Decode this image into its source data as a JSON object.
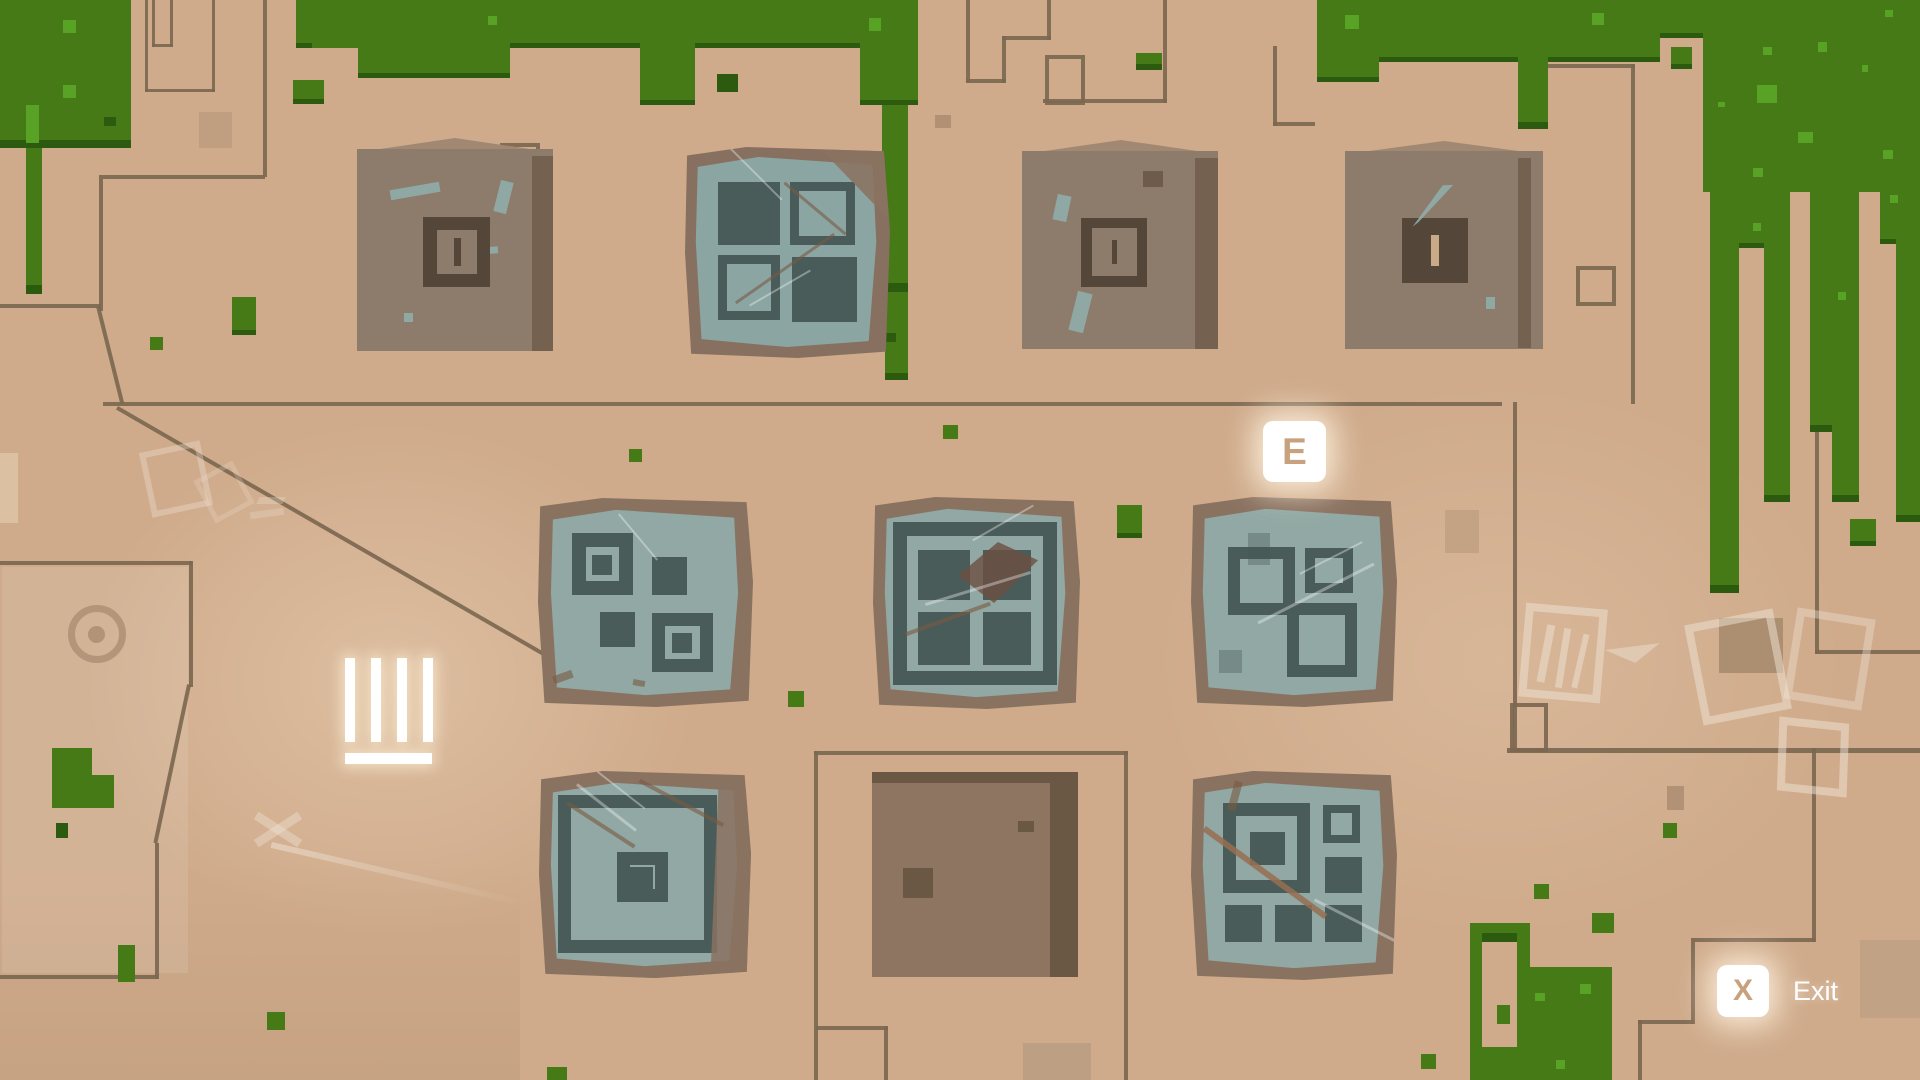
{
  "hud": {
    "interact_prompt": {
      "key": "E"
    },
    "exit_prompt": {
      "key": "X",
      "label": "Exit"
    },
    "progress_tally": {
      "count": 4
    }
  },
  "map": {
    "buildings": [
      {
        "numeral": "I"
      },
      {
        "numeral": "III"
      },
      {
        "numeral": "II"
      }
    ],
    "puzzle_panels": [
      {
        "id": "top-window",
        "motif": [
          "solid",
          "frame",
          "frame",
          "solid"
        ]
      },
      {
        "id": "mid-left",
        "motif": [
          "target",
          "solid",
          "solid",
          "target"
        ]
      },
      {
        "id": "mid-center",
        "motif": [
          "window-four-pane"
        ]
      },
      {
        "id": "mid-right",
        "motif": [
          "frame-large",
          "frame-small",
          "frame-medium"
        ]
      },
      {
        "id": "bottom-left",
        "motif": [
          "outer-frame",
          "center-target"
        ]
      },
      {
        "id": "bottom-right",
        "motif": [
          "target",
          "frame",
          "solid",
          "solid",
          "solid",
          "solid"
        ]
      }
    ]
  },
  "colors": {
    "ground": "#cfab8b",
    "grass": "#457a16",
    "grass_light": "#58a226",
    "grass_shadow": "#2c5a0e",
    "road": "#7c6750",
    "building": "#8d7b6b",
    "plaque": "#55463a",
    "panel_slate": "#91a8a4",
    "panel_square": "#4a5c59",
    "key_letter": "#c8a27e",
    "hud_white": "#ffffff"
  }
}
